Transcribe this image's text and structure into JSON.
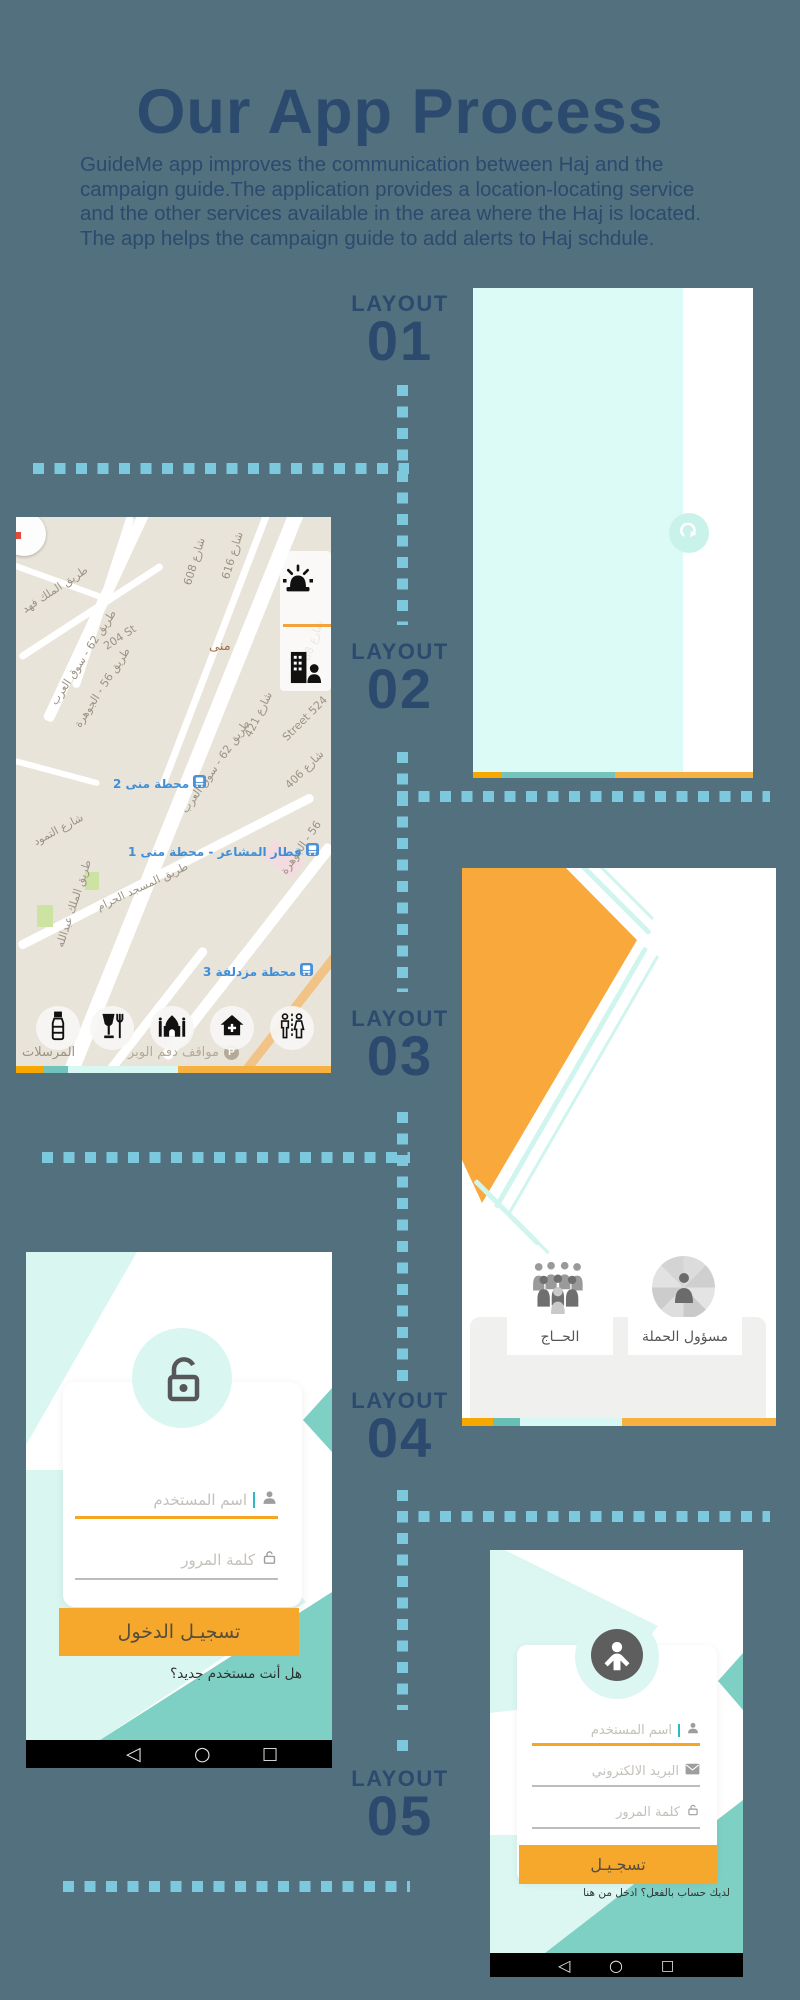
{
  "page": {
    "background": "#53707f"
  },
  "palette": {
    "navy_text": "#2b4a6e",
    "dot_blue": "#7cc9dd",
    "mint": "#dcfaf6",
    "teal": "#72c3bc",
    "dark_teal": "#7fd0c4",
    "light_cyan": "#d7f8f3",
    "orange": "#f6a800",
    "amber": "#f7b140",
    "button_orange": "#f6a82d",
    "map_beige": "#e9e4d9"
  },
  "header": {
    "title": "Our App Process",
    "description_lines": [
      "GuideMe app improves the communication between Haj and the",
      "campaign guide.The application provides a location-locating service",
      "and the other services available in the area where the Haj is located.",
      "The app helps the campaign guide to add alerts to Haj schdule."
    ]
  },
  "layout_labels": [
    {
      "word": "LAYOUT",
      "number": "01"
    },
    {
      "word": "LAYOUT",
      "number": "02"
    },
    {
      "word": "LAYOUT",
      "number": "03"
    },
    {
      "word": "LAYOUT",
      "number": "04"
    },
    {
      "word": "LAYOUT",
      "number": "05"
    }
  ],
  "screens": {
    "splash": {
      "icon": "curved-arrow-icon"
    },
    "map": {
      "street_labels": [
        {
          "text": "طريق الملك فهد"
        },
        {
          "text": "شارع 608"
        },
        {
          "text": "شارع 616"
        },
        {
          "text": "204 St"
        },
        {
          "text": "طريق 62 - سوق العرب"
        },
        {
          "text": "طريق 56 - الجوهرة"
        },
        {
          "text": "منى"
        },
        {
          "text": "شارع 421"
        },
        {
          "text": "Street 524"
        },
        {
          "text": "شارع 406"
        },
        {
          "text": "طريق 62 - سوق العرب"
        },
        {
          "text": "المرسلات"
        },
        {
          "text": "شارع التمود"
        },
        {
          "text": "طريق الملك عبدالله"
        },
        {
          "text": "طريق المسجد الحرام"
        },
        {
          "text": "56 - الجوهرة"
        },
        {
          "text": "شارع 88"
        }
      ],
      "transit_labels": [
        {
          "text": "محطة منى 2"
        },
        {
          "text": "قطار المشاعر - محطة منى 1"
        },
        {
          "text": "محطة مزدلفة 3"
        }
      ],
      "parking_label": "مواقف دقم الوبر",
      "parking_badge": "P",
      "action_icons": [
        "alarm-icon",
        "building-person-icon"
      ],
      "category_buttons": [
        "water-bottle-icon",
        "food-drink-icon",
        "mosque-icon",
        "home-add-icon",
        "restroom-icon"
      ]
    },
    "role_select": {
      "pilgrim_label": "الحــاج",
      "manager_label": "مسؤول الحملة"
    },
    "login": {
      "username_placeholder": "اسم المستخدم",
      "password_placeholder": "كلمة المرور",
      "submit_label": "تسجيـل الدخول",
      "new_user_prompt": "هل أنت مستخدم جديد؟"
    },
    "register": {
      "username_placeholder": "اسم المستخدم",
      "email_placeholder": "البريد الالكتروني",
      "password_placeholder": "كلمة المرور",
      "submit_label": "تسجـيـل",
      "signin_prompt": "لديك حساب بالفعل؟ ادخل من هنا"
    },
    "android_nav": {
      "back": "◁",
      "home": "○",
      "recents": "□"
    }
  }
}
